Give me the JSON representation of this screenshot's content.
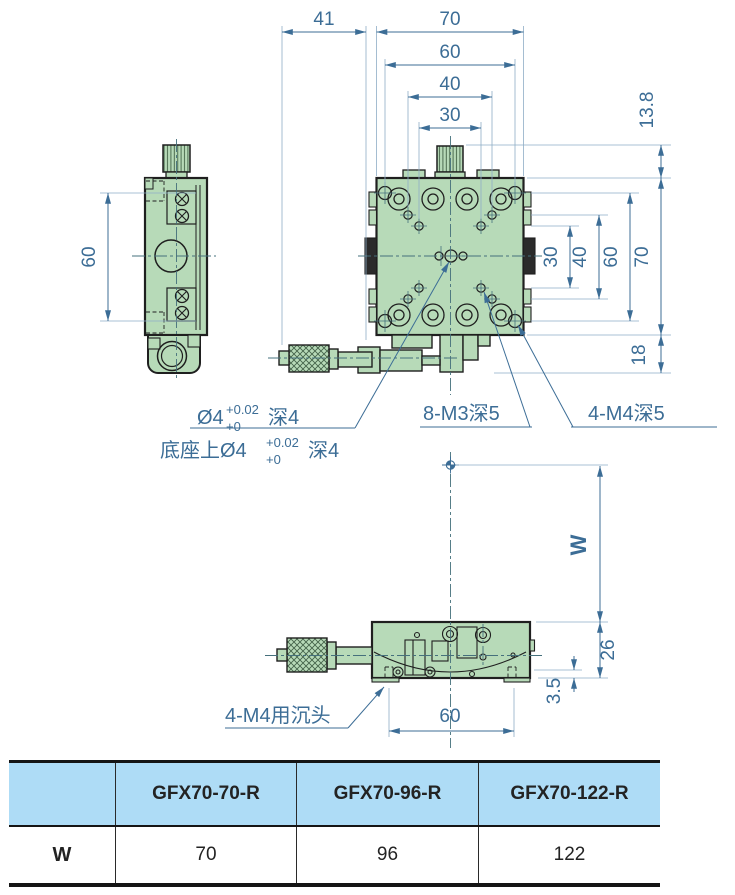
{
  "drawing": {
    "dims": {
      "top_41": "41",
      "top_70": "70",
      "top_60": "60",
      "top_40": "40",
      "top_30": "30",
      "right_13_8": "13.8",
      "right_70": "70",
      "right_60": "60",
      "right_40": "40",
      "right_30": "30",
      "right_18": "18",
      "left_60": "60",
      "bottom_W": "W",
      "bottom_26": "26",
      "bottom_3_5": "3.5",
      "bottom_60": "60"
    },
    "labels": {
      "hole_note_line1": {
        "prefix": "Ø4",
        "tol_upper": "+0.02",
        "tol_lower": "+0",
        "suffix": "深4"
      },
      "hole_note_line2": {
        "prefix": "底座上Ø4",
        "tol_upper": "+0.02",
        "tol_lower": "+0",
        "suffix": "深4"
      },
      "m3_note": "8-M3深5",
      "m4_note": "4-M4深5",
      "m4_counterbore_note": "4-M4用沉头"
    },
    "colors": {
      "part_fill": "#b7dab8",
      "outline": "#1f1f1f",
      "dimension_blue": "#3c6d96",
      "extension_blue": "#8fadc6",
      "centerline_teal": "#45707c",
      "table_header_bg": "#aedcf6"
    }
  },
  "table": {
    "columns": [
      "",
      "GFX70-70-R",
      "GFX70-96-R",
      "GFX70-122-R"
    ],
    "rows": [
      {
        "label": "W",
        "values": [
          "70",
          "96",
          "122"
        ]
      }
    ]
  }
}
